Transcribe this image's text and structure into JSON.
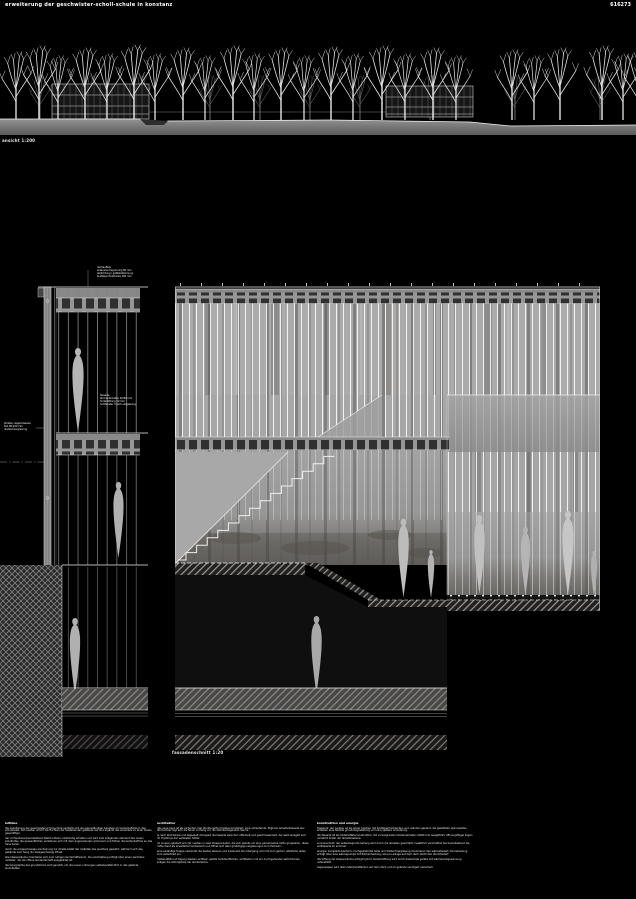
{
  "header": {
    "title": "erweiterung der geschwister-scholl-schule in konstanz",
    "code": "616273"
  },
  "site_elevation": {
    "label": "ansicht 1:200"
  },
  "facade_section": {
    "label": "fassadenschnitt 1:20"
  },
  "detail": {
    "annotations": {
      "top_lines": [
        "dachaufbau",
        "extensive begrünung 80 mm",
        "abdichtung / gefälledämmung",
        "brettsperrholzdecke 180 mm"
      ],
      "mid_lines": [
        "fassade",
        "lärchenlamellen 40/60 mm",
        "hinterlüftung 40 mm",
        "holzfenster 3-fach-verglasung"
      ],
      "left_lines": [
        "pfosten-riegel-fassade",
        "bsh 80/240 mm",
        "dreifachverglasung"
      ]
    }
  },
  "columns": [
    {
      "heading": "leitidee",
      "paragraphs": [
        "die erweiterung der geschwister-scholl-schule versteht sich als eigenständiger baustein im landschaftsraum des schulareals. der neubau nimmt die fluchten der bestehenden gebäude auf und ergänzt das ensemble zu einer klaren gesamtfigur.",
        "der vorhandene baumbestand bleibt nahezu vollständig erhalten und wird zum prägenden element des neuen schulhofes. die pausenflächen verzahnen sich mit dem angrenzenden grünraum und führen die landschaft bis an das haus heran.",
        "durch die eingeschossige erscheinung zur straße bleibt der maßstab des quartiers gewahrt, während sich das gebäude zum hang hin zweigeschossig öffnet.",
        "alle klassenräume orientieren sich zum ruhigen landschaftsraum. die erschließung erfolgt über einen zentralen verteiler, der als offene lernlandschaft ausgebildet ist.",
        "die topographie des grundstücks wird genutzt, um die neuen nutzungen selbstverständlich in das gelände einzubetten."
      ]
    },
    {
      "heading": "architektur",
      "paragraphs": [
        "das neue haus ist als einfacher, klar strukturierter holzbau konzipiert. eine umlaufende, filigrane lamellenfassade aus lärchenholz legt sich als feiner vorhang vor die dahinterliegenden räume.",
        "je nach blickwinkel und tageszeit changiert die fassade zwischen offenheit und geschlossenheit; der wald spiegelt sich im rhythmus der vertikalen hölzer.",
        "im inneren gliedert sich der neubau in zwei klassencluster, die sich jeweils um eine gemeinsame mitte gruppieren. diese mitte dient als erweiterter lernbereich und öffnet sich über großzügige verglasungen zum freiraum.",
        "eine einläufige treppe verbindet die beiden ebenen und inszeniert den übergang vom hof zum garten. sitzstufen laden zum aufenthalt ein.",
        "materialität und fügung bleiben sichtbar: geölte holzoberflächen, sichtbeton und ein durchgehender estrichboden prägen die atmosphäre der lernbereiche."
      ]
    },
    {
      "heading": "konstruktion und energie",
      "paragraphs": [
        "tragwerk: der neubau ist als reiner holzbau mit brettsperrholzdecken und -wänden geplant. die gewählten spannweiten erlauben eine flexible grundrissgestaltung und eine spätere umnutzung.",
        "die fassade ist als hinterlüftete konstruktion mit vorvergrauten lärchenlamellen 40/60 mm ausgeführt. öffnungsflügel liegen verdeckt hinter der lamellenebene.",
        "sonnenschutz: der außenliegende behang wird durch die lamellen geschützt; zusätzlich verschattet der baumbestand die südfassade im sommer.",
        "energie: kompakte bauform, hochgedämmte hülle und dreifachverglasung minimieren den wärmebedarf. die beheizung erfolgt über eine wärmepumpe mit flächenheizung; eine pv-anlage auf dem dach deckt den strombedarf.",
        "die lüftung der klassenräume erfolgt hybrid: fensterlüftung wird durch dezentrale geräte mit wärmerückgewinnung unterstützt.",
        "regenwasser wird über retentionsflächen auf dem dach und im gelände verzögert versickert."
      ]
    }
  ]
}
